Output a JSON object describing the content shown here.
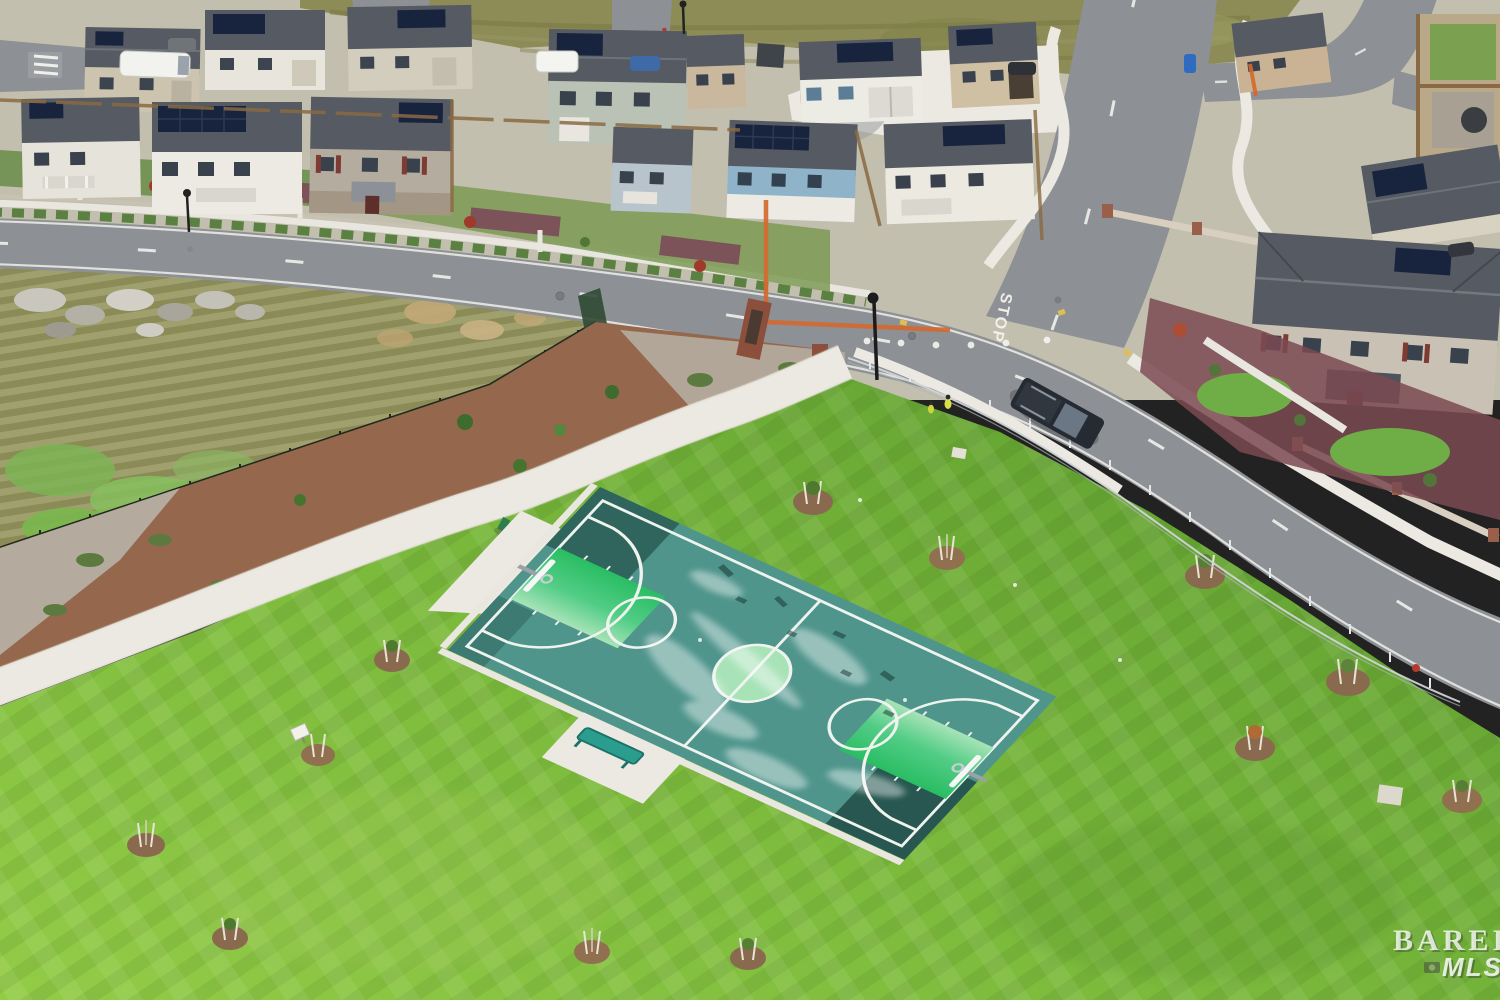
{
  "image": {
    "kind": "aerial-drone-photo",
    "description": "Aerial view of a new-construction suburban neighborhood with two-story homes with rooftop solar panels, a curving asphalt street with STOP pavement marking, and a community park containing a full basketball court with bright green keys and center circle, young staked trees in mulch rings, walking paths, a bench, an undeveloped scrub field with rocks, and a dark pickup truck parked at the intersection."
  },
  "watermark": {
    "line1": "BAREIS",
    "line2": "MLS",
    "icon": "camera-icon"
  },
  "road": {
    "stop_marking": "STOP"
  },
  "park": {
    "features": [
      "basketball-court",
      "bench",
      "drinking-fountain",
      "walking-path",
      "staked-young-trees",
      "mulch-planting-strip",
      "chain-link-fence",
      "lawn",
      "scrub-field",
      "rock-cluster"
    ]
  },
  "vehicles": [
    "dark-pickup-truck",
    "white-van",
    "white-sprinter-van",
    "blue-car",
    "gray-car",
    "dark-suv"
  ],
  "palette": {
    "lawn_light": "#93cc47",
    "lawn_deep": "#61a031",
    "court_teal": "#4f958c",
    "court_dark": "#2c5f58",
    "key_green": "#2bbf66",
    "key_pale": "#a8e3b8",
    "court_line": "#eef3ee",
    "road_asphalt": "#8d9094",
    "concrete": "#ebe9e1",
    "mulch_red": "#95674c",
    "gravel": "#b7b2a7",
    "field_olive": "#999a64",
    "hill_olive": "#8d8b56",
    "roof_gray": "#565a62",
    "solar_navy": "#18243d",
    "wood_fence": "#8a6a43",
    "orange_fence": "#d4692f",
    "bench_teal": "#2a9d8f",
    "truck_dark": "#262b33",
    "stop_white": "#f4f3ee",
    "watermark_white": "#ffffff"
  }
}
